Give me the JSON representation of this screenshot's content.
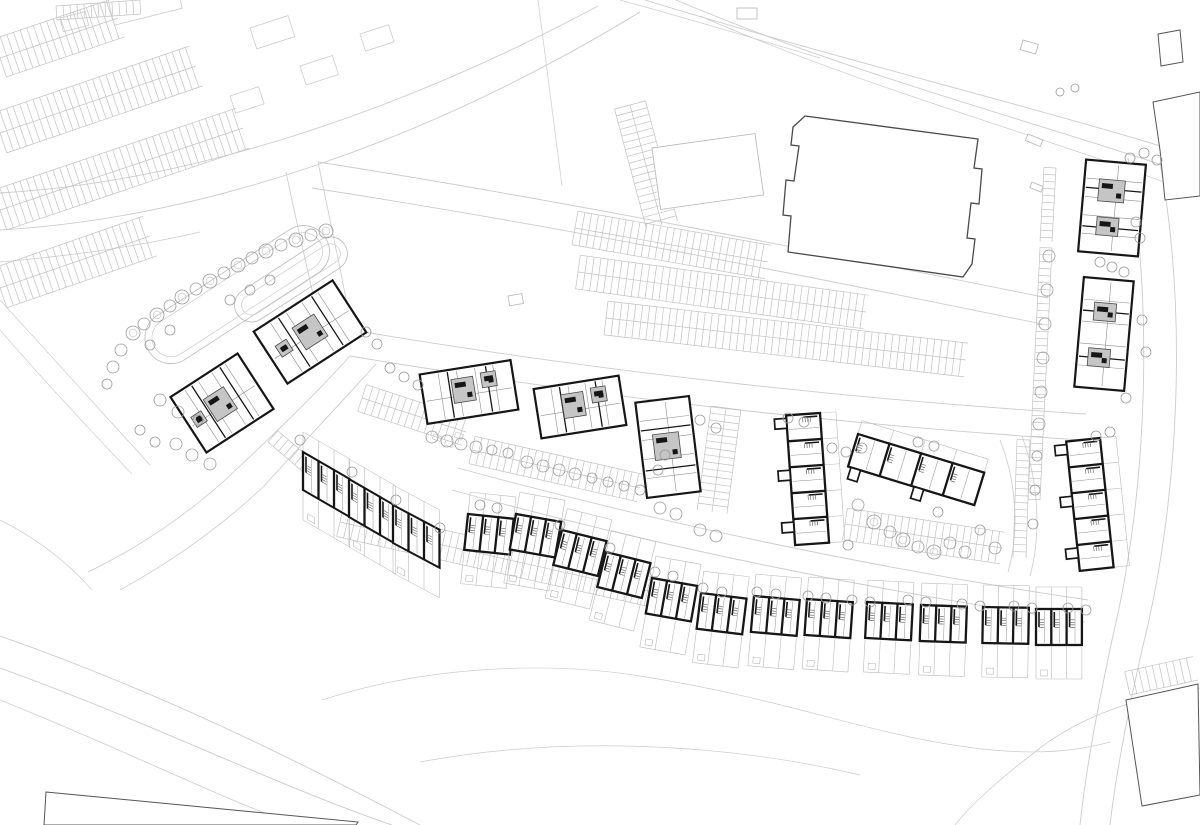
{
  "canvas": {
    "w": 1200,
    "h": 825
  },
  "palette": {
    "paper": "#ffffff",
    "context_line": "#cccccc",
    "context_line2": "#bfbfbf",
    "context_dark": "#555555",
    "wall": "#161616",
    "interior": "#8f8f8f",
    "interior_light": "#b5b5b5",
    "core_fill": "#c5c5c5",
    "core_edge": "#4a4a4a",
    "tree": "#9b9b9b",
    "parking": "#c2c2c2",
    "garden": "#bbbbbb",
    "store_edge": "#4a4a4a"
  },
  "roads": [
    {
      "d": "M0,193 C190,182 400,112 598,6",
      "w": 0.9
    },
    {
      "d": "M0,230 C205,218 430,140 640,12",
      "w": 0.9
    },
    {
      "d": "M0,262 C70,256 140,246 200,232",
      "w": 0.8
    },
    {
      "d": "M645,0 C840,60 1030,105 1200,158",
      "w": 0.9
    },
    {
      "d": "M676,0 C860,78 1040,122 1200,178",
      "w": 0.9
    },
    {
      "d": "M700,16 C880,94 1060,140 1200,196",
      "w": 0.7
    },
    {
      "d": "M620,0 C700,22 760,40 820,58",
      "w": 0.7
    },
    {
      "d": "M538,0 C546,64 554,128 562,186",
      "w": 0.7
    },
    {
      "d": "M318,162 C560,200 820,252 1048,298",
      "w": 0.9
    },
    {
      "d": "M312,188 C560,226 816,278 1042,324",
      "w": 0.9
    },
    {
      "d": "M318,162 C330,220 342,276 352,330",
      "w": 0.8
    },
    {
      "d": "M286,172 C298,230 312,288 324,344",
      "w": 0.8
    },
    {
      "d": "M352,330 C600,372 860,400 1086,414",
      "w": 0.9
    },
    {
      "d": "M350,356 C600,398 858,426 1082,440",
      "w": 0.9
    },
    {
      "d": "M350,356 C312,398 276,432 238,468",
      "w": 0.9
    },
    {
      "d": "M376,364 C338,406 302,444 264,486",
      "w": 0.9
    },
    {
      "d": "M238,468 C196,508 146,544 88,572",
      "w": 0.8
    },
    {
      "d": "M264,486 C224,524 178,558 120,590",
      "w": 0.8
    },
    {
      "d": "M452,490 C650,545 870,590 1085,622",
      "w": 0.9
    },
    {
      "d": "M458,468 C655,522 872,568 1088,600",
      "w": 0.9
    },
    {
      "d": "M1128,158 C1152,300 1150,480 1112,640 C1098,706 1086,768 1080,825",
      "w": 0.9
    },
    {
      "d": "M1160,162 C1186,305 1182,488 1142,650 C1128,712 1116,772 1110,825",
      "w": 0.9
    },
    {
      "d": "M1000,440 C1016,480 1020,530 1008,572",
      "w": 0.8
    },
    {
      "d": "M1022,436 C1038,480 1042,532 1030,576",
      "w": 0.8
    },
    {
      "d": "M0,636 C160,692 300,762 420,825",
      "w": 0.9
    },
    {
      "d": "M0,668 C150,722 282,788 392,825",
      "w": 0.9
    },
    {
      "d": "M0,700 C130,752 250,812 300,825",
      "w": 0.8
    },
    {
      "d": "M322,700 C420,668 540,660 640,676 C760,695 830,720 910,737 C1000,756 1060,756 1110,742",
      "w": 0.7
    },
    {
      "d": "M420,762 C560,736 720,742 860,775",
      "w": 0.7
    },
    {
      "d": "M1200,688 C1140,696 1082,716 1040,748 C1005,775 975,800 955,825",
      "w": 0.8
    },
    {
      "d": "M0,520 C40,540 70,565 92,590",
      "w": 0.7
    },
    {
      "d": "M0,300 C55,360 105,415 150,465",
      "w": 0.7
    },
    {
      "d": "M0,330 C45,382 90,430 132,474",
      "w": 0.7
    }
  ],
  "combs": [
    {
      "x1": 0,
      "y1": 58,
      "x2": 118,
      "y2": 18,
      "len": 20,
      "side": "both"
    },
    {
      "x1": 0,
      "y1": 133,
      "x2": 196,
      "y2": 66,
      "len": 21,
      "side": "both"
    },
    {
      "x1": 0,
      "y1": 210,
      "x2": 243,
      "y2": 128,
      "len": 21,
      "side": "both"
    },
    {
      "x1": 0,
      "y1": 288,
      "x2": 150,
      "y2": 236,
      "len": 21,
      "side": "both"
    },
    {
      "x1": 56,
      "y1": 6,
      "x2": 140,
      "y2": 0,
      "len": 14,
      "side": "right"
    },
    {
      "x1": 575,
      "y1": 228,
      "x2": 768,
      "y2": 262,
      "len": 17,
      "side": "both"
    },
    {
      "x1": 578,
      "y1": 272,
      "x2": 866,
      "y2": 312,
      "len": 17,
      "side": "both"
    },
    {
      "x1": 606,
      "y1": 318,
      "x2": 966,
      "y2": 360,
      "len": 17,
      "side": "both"
    },
    {
      "x1": 630,
      "y1": 105,
      "x2": 662,
      "y2": 225,
      "len": 16,
      "side": "both"
    },
    {
      "x1": 268,
      "y1": 442,
      "x2": 350,
      "y2": 512,
      "len": 15,
      "side": "left"
    },
    {
      "x1": 362,
      "y1": 398,
      "x2": 466,
      "y2": 432,
      "len": 14,
      "side": "both"
    },
    {
      "x1": 472,
      "y1": 450,
      "x2": 640,
      "y2": 488,
      "len": 14,
      "side": "both"
    },
    {
      "x1": 726,
      "y1": 408,
      "x2": 712,
      "y2": 512,
      "len": 15,
      "side": "both"
    },
    {
      "x1": 340,
      "y1": 522,
      "x2": 652,
      "y2": 592,
      "len": 15,
      "side": "both"
    },
    {
      "x1": 845,
      "y1": 524,
      "x2": 1002,
      "y2": 548,
      "len": 16,
      "side": "both"
    },
    {
      "x1": 1030,
      "y1": 440,
      "x2": 1026,
      "y2": 558,
      "len": 13,
      "side": "right"
    },
    {
      "x1": 1056,
      "y1": 168,
      "x2": 1052,
      "y2": 242,
      "len": 12,
      "side": "right"
    },
    {
      "x1": 1052,
      "y1": 248,
      "x2": 1040,
      "y2": 500,
      "len": 12,
      "side": "right"
    },
    {
      "x1": 1130,
      "y1": 695,
      "x2": 1198,
      "y2": 680,
      "len": 24,
      "side": "left"
    }
  ],
  "ponds": [
    {
      "x": 135,
      "y": 330,
      "w": 210,
      "h": 52,
      "rot": -33,
      "rx": 26
    },
    {
      "x": 228,
      "y": 300,
      "w": 128,
      "h": 34,
      "rot": -33,
      "rx": 17
    }
  ],
  "store": {
    "path": "M805,116 L978,139 L974,168 L982,169 L979,204 L971,203 L967,238 L975,239 L972,264 L963,277 L788,252 L791,216 L783,215 L786,180 L794,181 L799,146 L791,145 L793,127 Z"
  },
  "islands": [
    {
      "x": 652,
      "y": 148,
      "w": 104,
      "h": 62,
      "rot": -8
    },
    {
      "x": 1028,
      "y": 134,
      "w": 16,
      "h": 7,
      "rot": 22
    },
    {
      "x": 1032,
      "y": 182,
      "w": 12,
      "h": 6,
      "rot": 22
    },
    {
      "x": 737,
      "y": 8,
      "w": 20,
      "h": 11,
      "rot": 0
    },
    {
      "x": 1023,
      "y": 40,
      "w": 16,
      "h": 10,
      "rot": 16
    },
    {
      "x": 508,
      "y": 296,
      "w": 14,
      "h": 10,
      "rot": -10
    }
  ],
  "context_rects": [
    {
      "x": 108,
      "y": 0,
      "w": 70,
      "h": 26,
      "rot": -14
    },
    {
      "x": 60,
      "y": 18,
      "w": 26,
      "h": 14,
      "rot": -14
    },
    {
      "x": 250,
      "y": 28,
      "w": 40,
      "h": 22,
      "rot": -18
    },
    {
      "x": 300,
      "y": 66,
      "w": 34,
      "h": 20,
      "rot": -18
    },
    {
      "x": 360,
      "y": 34,
      "w": 30,
      "h": 18,
      "rot": -18
    },
    {
      "x": 230,
      "y": 96,
      "w": 30,
      "h": 18,
      "rot": -18
    },
    {
      "x": 434,
      "y": 434,
      "w": 8,
      "h": 5,
      "rot": 20
    },
    {
      "x": 446,
      "y": 440,
      "w": 8,
      "h": 5,
      "rot": 20
    },
    {
      "x": 456,
      "y": 432,
      "w": 8,
      "h": 5,
      "rot": 20
    }
  ],
  "context_buildings": [
    {
      "points": "1158,34 1180,30 1183,62 1161,66"
    },
    {
      "points": "1153,102 1200,92 1200,196 1165,200 1160,150"
    },
    {
      "points": "1126,700 1198,684 1200,795 1142,806"
    },
    {
      "points": "46,792 358,822 356,825 44,825"
    }
  ],
  "apartments": [
    {
      "cx": 310,
      "cy": 332,
      "w": 94,
      "h": 62,
      "rot": -33,
      "axis": "h",
      "cores": [
        {
          "x": 34,
          "y": 18,
          "w": 26,
          "h": 26
        },
        {
          "x": 10,
          "y": 24,
          "w": 13,
          "h": 13
        }
      ]
    },
    {
      "cx": 222,
      "cy": 403,
      "w": 80,
      "h": 66,
      "rot": -33,
      "axis": "h",
      "cores": [
        {
          "x": 26,
          "y": 20,
          "w": 24,
          "h": 26
        },
        {
          "x": 6,
          "y": 28,
          "w": 12,
          "h": 12
        }
      ]
    },
    {
      "cx": 469,
      "cy": 392,
      "w": 92,
      "h": 50,
      "rot": -9,
      "axis": "h",
      "cores": [
        {
          "x": 30,
          "y": 10,
          "w": 22,
          "h": 24
        },
        {
          "x": 60,
          "y": 8,
          "w": 15,
          "h": 15
        }
      ]
    },
    {
      "cx": 580,
      "cy": 407,
      "w": 86,
      "h": 50,
      "rot": -9,
      "axis": "h",
      "cores": [
        {
          "x": 26,
          "y": 10,
          "w": 22,
          "h": 24
        },
        {
          "x": 56,
          "y": 8,
          "w": 15,
          "h": 15
        }
      ]
    },
    {
      "cx": 668,
      "cy": 447,
      "w": 54,
      "h": 96,
      "rot": -7,
      "axis": "v",
      "cores": [
        {
          "x": 13,
          "y": 34,
          "w": 26,
          "h": 26
        }
      ]
    },
    {
      "cx": 1112,
      "cy": 208,
      "w": 60,
      "h": 92,
      "rot": 5,
      "axis": "v",
      "cores": [
        {
          "x": 15,
          "y": 18,
          "w": 26,
          "h": 22
        },
        {
          "x": 16,
          "y": 56,
          "w": 22,
          "h": 18
        }
      ]
    },
    {
      "cx": 1104,
      "cy": 334,
      "w": 50,
      "h": 110,
      "rot": 5,
      "axis": "v",
      "cores": [
        {
          "x": 13,
          "y": 24,
          "w": 22,
          "h": 18
        },
        {
          "x": 11,
          "y": 70,
          "w": 22,
          "h": 18
        }
      ]
    }
  ],
  "terraces": [
    {
      "x": 303,
      "y": 452,
      "units": 3,
      "uw": 15.5,
      "h": 38,
      "skew": 30,
      "gTop": 20,
      "gBot": 30,
      "wings": false
    },
    {
      "x": 349,
      "y": 479,
      "units": 3,
      "uw": 15.5,
      "h": 38,
      "skew": 30,
      "gTop": 20,
      "gBot": 30,
      "wings": false
    },
    {
      "x": 393,
      "y": 505,
      "units": 3,
      "uw": 15.5,
      "h": 38,
      "skew": 28,
      "gTop": 20,
      "gBot": 30,
      "wings": false
    },
    {
      "x": 468,
      "y": 514,
      "units": 3,
      "uw": 15.3,
      "h": 36,
      "rot": 6,
      "gTop": 22,
      "gBot": 34,
      "wings": false
    },
    {
      "x": 516,
      "y": 514,
      "units": 3,
      "uw": 15.3,
      "h": 36,
      "rot": 10,
      "gTop": 22,
      "gBot": 34,
      "wings": false
    },
    {
      "x": 562,
      "y": 530,
      "units": 3,
      "uw": 15.3,
      "h": 36,
      "rot": 14,
      "gTop": 22,
      "gBot": 34,
      "wings": false
    },
    {
      "x": 606,
      "y": 552,
      "units": 3,
      "uw": 15.3,
      "h": 36,
      "rot": 14,
      "gTop": 22,
      "gBot": 34,
      "wings": false
    },
    {
      "x": 652,
      "y": 578,
      "units": 3,
      "uw": 15.3,
      "h": 36,
      "rot": 10,
      "gTop": 22,
      "gBot": 34,
      "wings": false
    },
    {
      "x": 701,
      "y": 593,
      "units": 3,
      "uw": 15.3,
      "h": 36,
      "rot": 7,
      "gTop": 22,
      "gBot": 34,
      "wings": false
    },
    {
      "x": 754,
      "y": 596,
      "units": 3,
      "uw": 15.3,
      "h": 36,
      "rot": 5,
      "gTop": 22,
      "gBot": 34,
      "wings": false
    },
    {
      "x": 807,
      "y": 599,
      "units": 3,
      "uw": 15.3,
      "h": 36,
      "rot": 4,
      "gTop": 22,
      "gBot": 34,
      "wings": false
    },
    {
      "x": 867,
      "y": 602,
      "units": 3,
      "uw": 15.3,
      "h": 36,
      "rot": 3,
      "gTop": 22,
      "gBot": 34,
      "wings": false
    },
    {
      "x": 921,
      "y": 605,
      "units": 3,
      "uw": 15.3,
      "h": 36,
      "rot": 2,
      "gTop": 22,
      "gBot": 34,
      "wings": false
    },
    {
      "x": 983,
      "y": 607,
      "units": 3,
      "uw": 15.3,
      "h": 36,
      "rot": 1,
      "gTop": 22,
      "gBot": 34,
      "wings": false
    },
    {
      "x": 1036,
      "y": 609,
      "units": 3,
      "uw": 15.3,
      "h": 36,
      "rot": 0,
      "gTop": 22,
      "gBot": 34,
      "wings": false
    },
    {
      "x": 820,
      "y": 413,
      "units": 5,
      "uw": 26,
      "h": 34,
      "rot": 86,
      "gTop": 16,
      "gBot": 0,
      "wings": true
    },
    {
      "x": 858,
      "y": 434,
      "units": 4,
      "uw": 33,
      "h": 34,
      "rot": 17,
      "gTop": 14,
      "gBot": 0,
      "wings": true
    },
    {
      "x": 1100,
      "y": 438,
      "units": 5,
      "uw": 26,
      "h": 34,
      "rot": 84,
      "gTop": 16,
      "gBot": 0,
      "wings": true
    }
  ],
  "trees": [
    [
      133,
      333,
      7
    ],
    [
      144,
      324,
      6
    ],
    [
      157,
      315,
      7
    ],
    [
      170,
      306,
      6
    ],
    [
      182,
      297,
      7
    ],
    [
      196,
      289,
      6
    ],
    [
      210,
      281,
      7
    ],
    [
      224,
      273,
      6
    ],
    [
      238,
      265,
      7
    ],
    [
      252,
      258,
      6
    ],
    [
      266,
      251,
      7
    ],
    [
      281,
      245,
      6
    ],
    [
      296,
      240,
      7
    ],
    [
      311,
      235,
      6
    ],
    [
      326,
      231,
      7
    ],
    [
      121,
      350,
      6
    ],
    [
      113,
      367,
      6
    ],
    [
      107,
      384,
      5
    ],
    [
      150,
      345,
      5
    ],
    [
      170,
      330,
      5
    ],
    [
      160,
      400,
      6
    ],
    [
      178,
      412,
      6
    ],
    [
      198,
      420,
      5
    ],
    [
      230,
      300,
      5
    ],
    [
      250,
      290,
      5
    ],
    [
      270,
      280,
      5
    ],
    [
      140,
      430,
      5
    ],
    [
      155,
      442,
      5
    ],
    [
      176,
      444,
      6
    ],
    [
      192,
      455,
      6
    ],
    [
      210,
      464,
      6
    ],
    [
      366,
      332,
      5
    ],
    [
      377,
      344,
      5
    ],
    [
      390,
      368,
      5
    ],
    [
      404,
      377,
      5
    ],
    [
      418,
      385,
      5
    ],
    [
      432,
      437,
      6
    ],
    [
      447,
      441,
      6
    ],
    [
      461,
      444,
      6
    ],
    [
      476,
      447,
      6
    ],
    [
      492,
      450,
      5
    ],
    [
      508,
      453,
      5
    ],
    [
      527,
      462,
      6
    ],
    [
      543,
      466,
      6
    ],
    [
      559,
      470,
      6
    ],
    [
      575,
      474,
      6
    ],
    [
      592,
      478,
      5
    ],
    [
      608,
      482,
      5
    ],
    [
      624,
      486,
      5
    ],
    [
      640,
      490,
      5
    ],
    [
      658,
      470,
      5
    ],
    [
      665,
      455,
      5
    ],
    [
      700,
      420,
      5
    ],
    [
      716,
      428,
      5
    ],
    [
      700,
      530,
      6
    ],
    [
      716,
      536,
      6
    ],
    [
      660,
      508,
      6
    ],
    [
      676,
      514,
      6
    ],
    [
      480,
      505,
      5
    ],
    [
      497,
      508,
      5
    ],
    [
      560,
      525,
      5
    ],
    [
      610,
      548,
      5
    ],
    [
      655,
      572,
      5
    ],
    [
      673,
      576,
      5
    ],
    [
      703,
      588,
      5
    ],
    [
      722,
      592,
      5
    ],
    [
      757,
      592,
      5
    ],
    [
      776,
      594,
      5
    ],
    [
      808,
      596,
      5
    ],
    [
      826,
      598,
      5
    ],
    [
      852,
      600,
      5
    ],
    [
      870,
      602,
      5
    ],
    [
      908,
      600,
      5
    ],
    [
      926,
      602,
      5
    ],
    [
      962,
      604,
      5
    ],
    [
      980,
      606,
      5
    ],
    [
      1014,
      606,
      5
    ],
    [
      1032,
      608,
      5
    ],
    [
      1068,
      608,
      5
    ],
    [
      1086,
      610,
      5
    ],
    [
      352,
      472,
      5
    ],
    [
      396,
      500,
      5
    ],
    [
      440,
      528,
      5
    ],
    [
      300,
      440,
      5
    ],
    [
      858,
      505,
      6
    ],
    [
      874,
      522,
      7
    ],
    [
      890,
      532,
      6
    ],
    [
      903,
      540,
      7
    ],
    [
      918,
      547,
      6
    ],
    [
      934,
      552,
      7
    ],
    [
      950,
      543,
      6
    ],
    [
      938,
      512,
      5
    ],
    [
      965,
      552,
      6
    ],
    [
      980,
      530,
      5
    ],
    [
      848,
      545,
      5
    ],
    [
      995,
      548,
      6
    ],
    [
      832,
      448,
      5
    ],
    [
      846,
      452,
      5
    ],
    [
      862,
      448,
      5
    ],
    [
      918,
      442,
      5
    ],
    [
      934,
      446,
      5
    ],
    [
      788,
      418,
      5
    ],
    [
      804,
      422,
      5
    ],
    [
      1049,
      256,
      6
    ],
    [
      1047,
      290,
      6
    ],
    [
      1045,
      324,
      6
    ],
    [
      1043,
      358,
      6
    ],
    [
      1041,
      392,
      6
    ],
    [
      1039,
      424,
      6
    ],
    [
      1037,
      456,
      5
    ],
    [
      1035,
      490,
      5
    ],
    [
      1033,
      524,
      5
    ],
    [
      1130,
      158,
      5
    ],
    [
      1144,
      153,
      5
    ],
    [
      1157,
      160,
      5
    ],
    [
      1136,
      222,
      5
    ],
    [
      1140,
      238,
      5
    ],
    [
      1100,
      262,
      5
    ],
    [
      1112,
      267,
      5
    ],
    [
      1124,
      272,
      5
    ],
    [
      1142,
      320,
      5
    ],
    [
      1146,
      352,
      5
    ],
    [
      1126,
      398,
      5
    ],
    [
      1110,
      432,
      5
    ],
    [
      1096,
      436,
      5
    ],
    [
      1060,
      92,
      4
    ],
    [
      1075,
      88,
      4
    ]
  ]
}
